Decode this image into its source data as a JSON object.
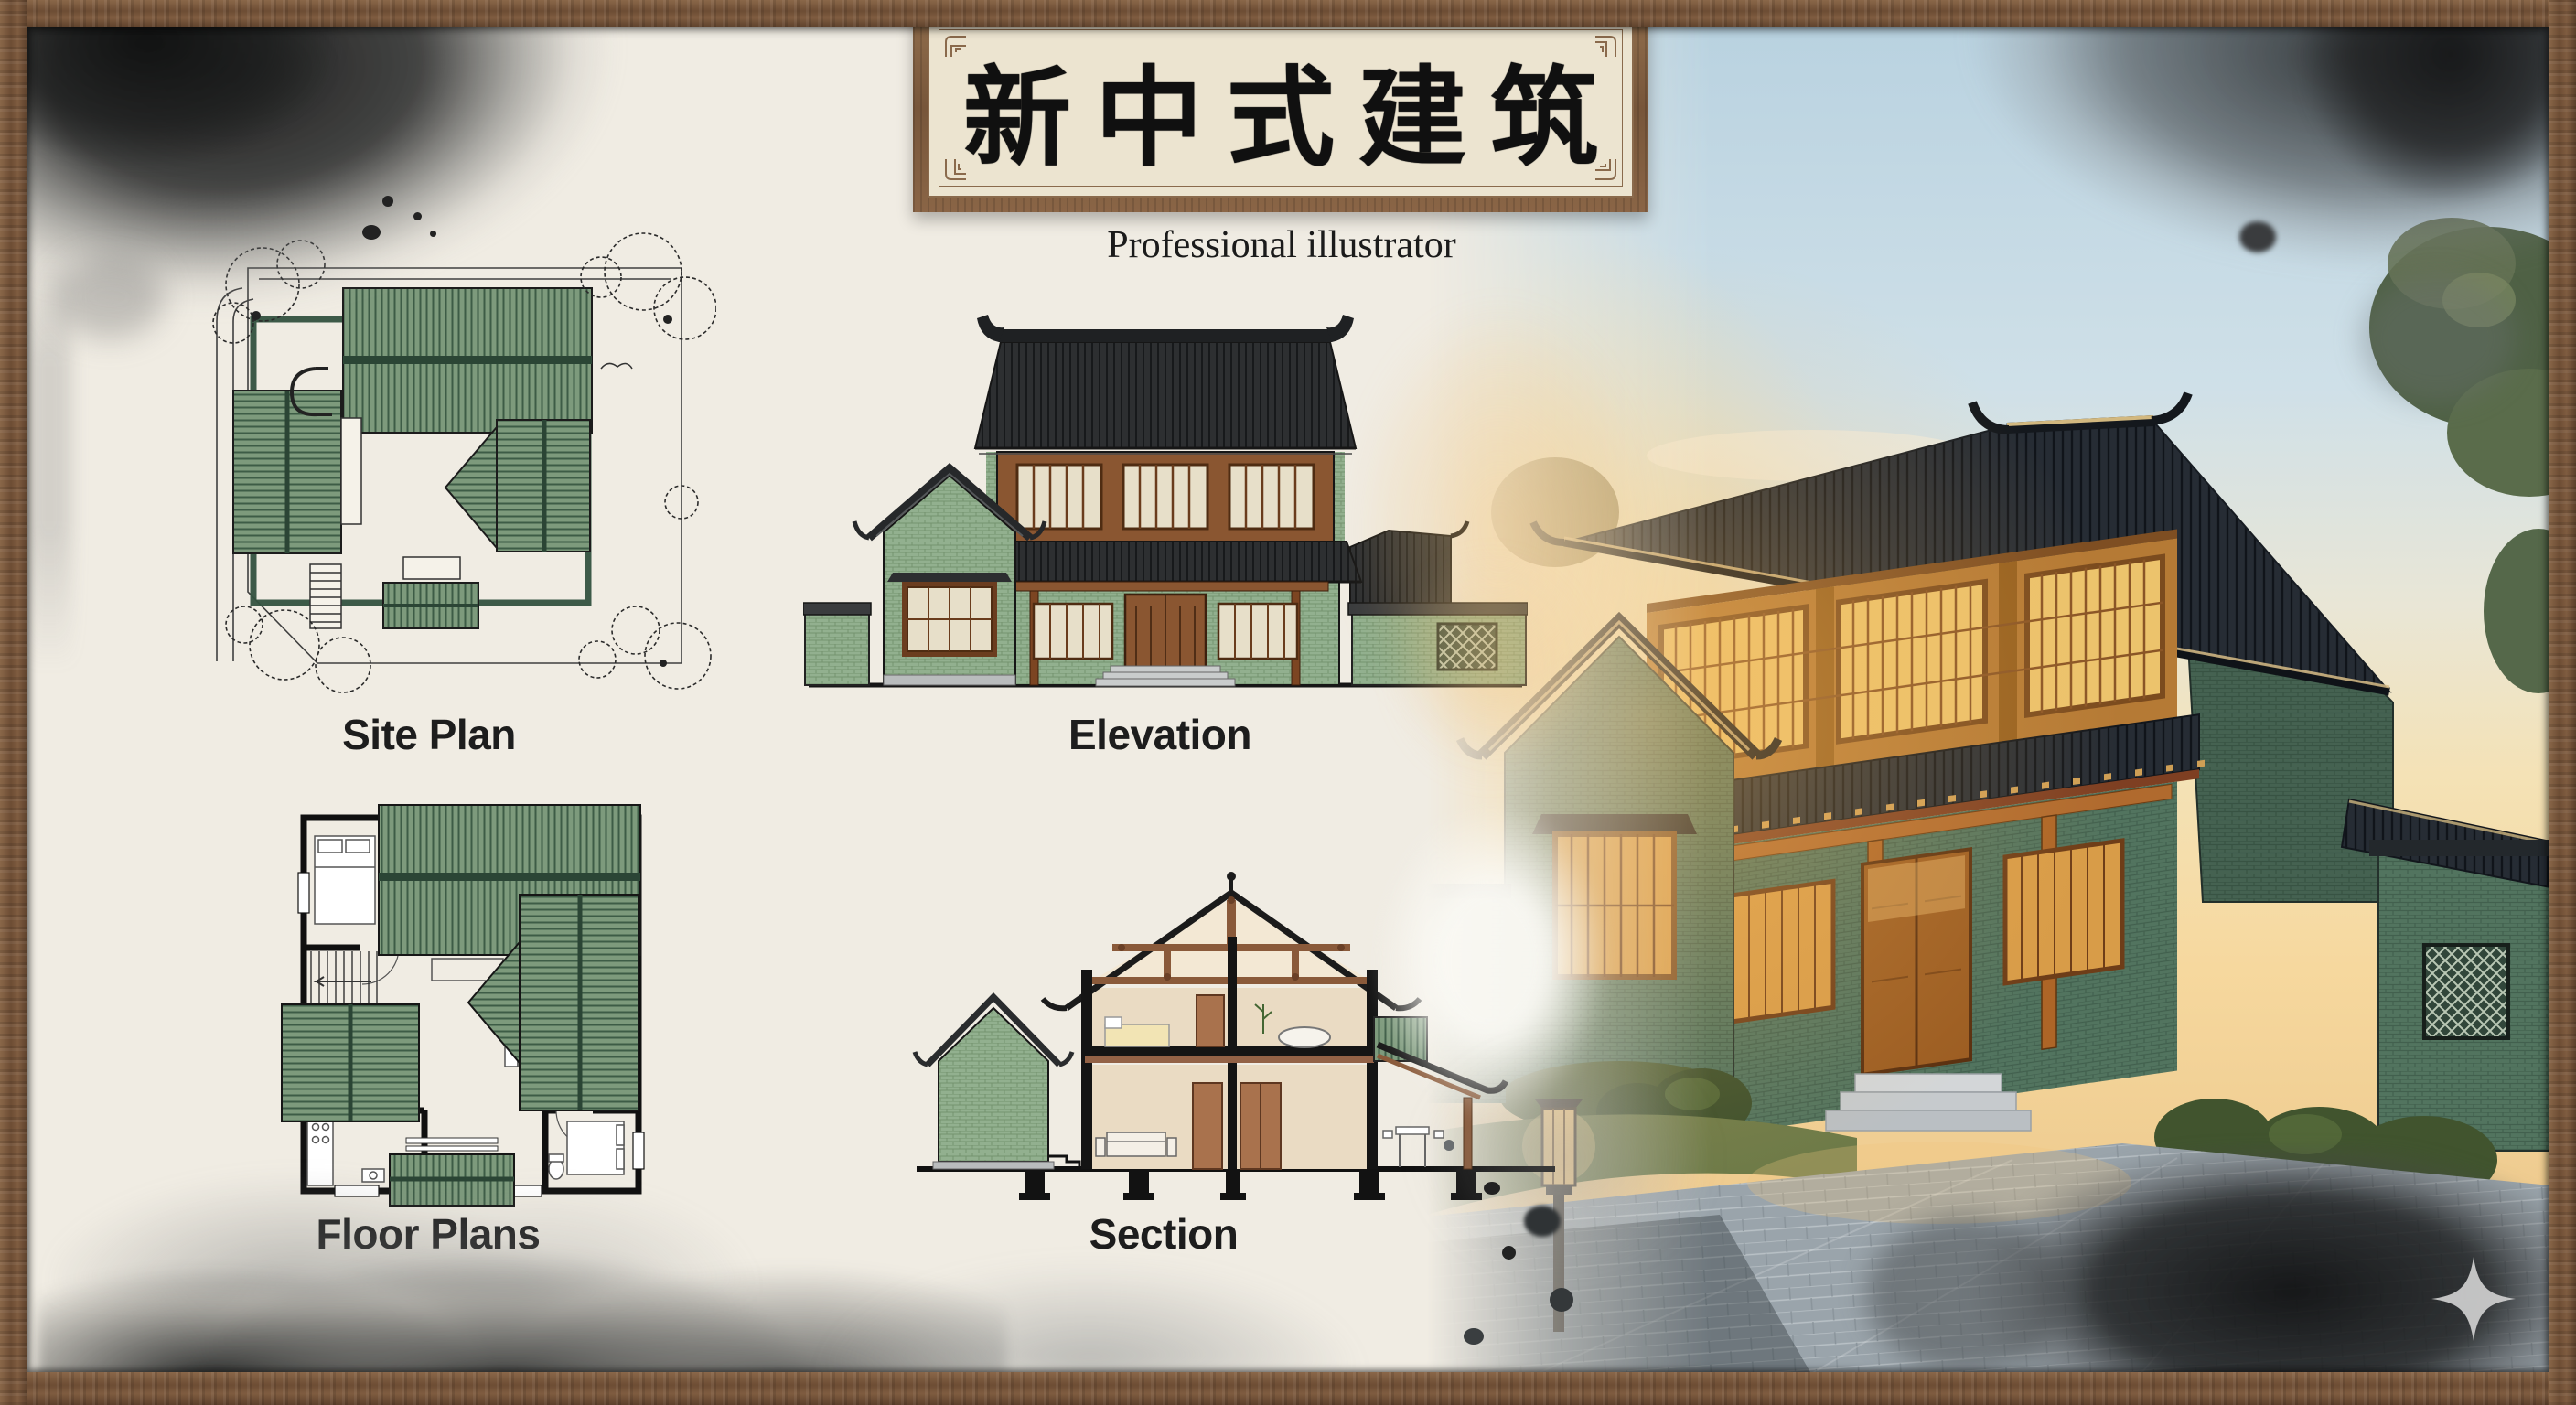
{
  "artwork": {
    "title": "新中式建筑",
    "subtitle": "Professional illustrator"
  },
  "panels": [
    {
      "id": "site-plan",
      "label": "Site Plan"
    },
    {
      "id": "elevation",
      "label": "Elevation"
    },
    {
      "id": "floor-plans",
      "label": "Floor Plans"
    },
    {
      "id": "section",
      "label": "Section"
    }
  ],
  "icons": {
    "sparkle": "four-pointed-star-watermark"
  },
  "colors": {
    "frame_wood": "#7a573b",
    "paper": "#f0ece3",
    "ink_wash": "#1e2021",
    "drawing_roof_green": "#7d9a7c",
    "drawing_roof_dark": "#2d2f31",
    "drawing_brick_green": "#92b08f",
    "render_brick_green": "#52745f",
    "render_wood_warm": "#c08440",
    "render_sky_blue": "#c3d8e3",
    "render_sky_warm": "#f3d49a",
    "paving_gray": "#9aa4ab"
  }
}
